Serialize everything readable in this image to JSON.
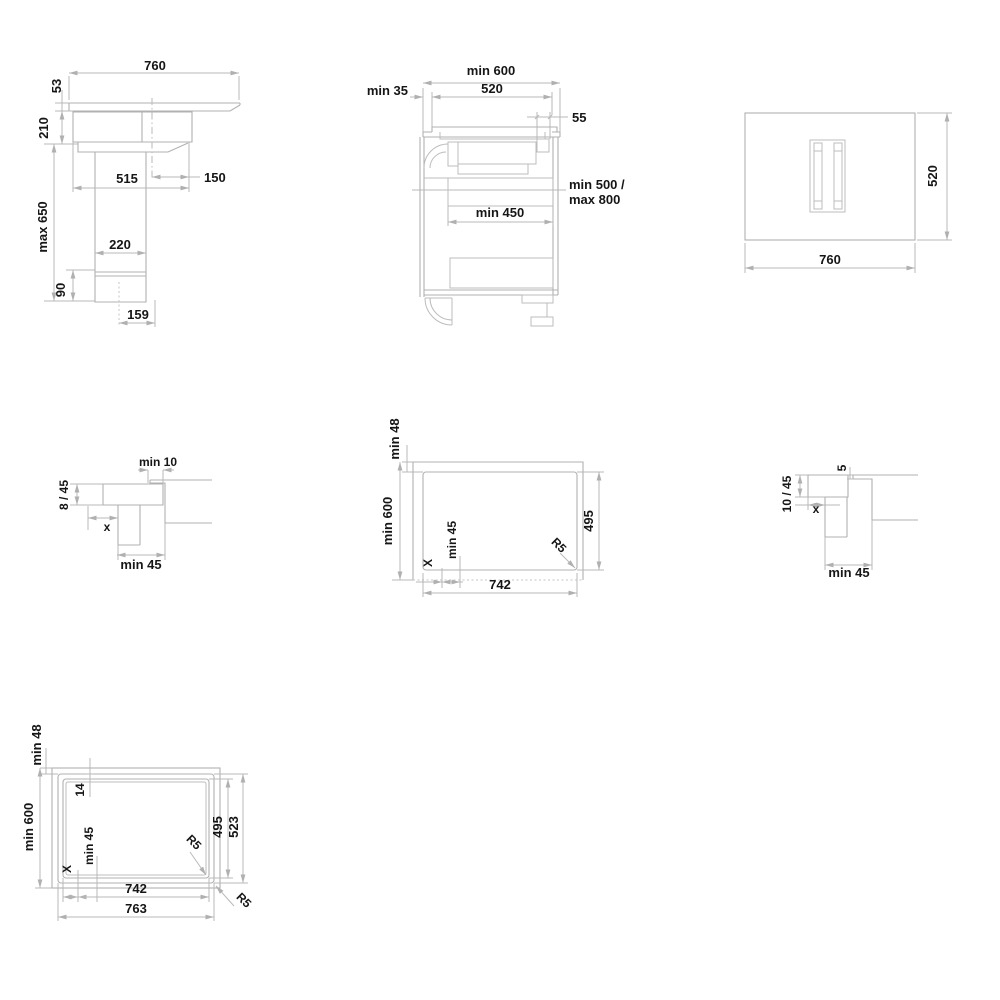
{
  "document": {
    "type": "appliance installation drawing",
    "subject": "downdraft induction hob – installation dimensions (mm)",
    "colors": {
      "line": "#b1b1b1",
      "dimension_line": "#b9b9b9",
      "text": "#161616",
      "background": "#ffffff"
    }
  },
  "v1": {
    "view": "side view hob with downdraft duct",
    "width": "760",
    "glass_h": "53",
    "housing_h": "210",
    "duct_max": "max 650",
    "body_w": "515",
    "offset": "150",
    "duct_w": "220",
    "outlet_h": "90",
    "outlet_w": "159"
  },
  "v2": {
    "view": "side view installed in base cabinet",
    "worktop_depth": "min 600",
    "hob_depth": "520",
    "front_clearance": "min 35",
    "rear_section": "55",
    "outlet_line1": "min 500 /",
    "outlet_line2": "max 800",
    "interior_depth": "min 450"
  },
  "v3": {
    "view": "top view hob",
    "width": "760",
    "depth": "520"
  },
  "v4": {
    "view": "edge detail surface mounted",
    "gap": "min 10",
    "height": "8 / 45",
    "x": "x",
    "clearance": "min 45"
  },
  "v5": {
    "view": "worktop cutout top view",
    "rear_clearance": "min 48",
    "worktop_depth": "min 600",
    "x": "X",
    "side_clearance": "min 45",
    "radius": "R5",
    "cutout_depth": "495",
    "cutout_width": "742"
  },
  "v6": {
    "view": "edge detail semi-flush mounted",
    "step": "5",
    "height": "10 / 45",
    "x": "x",
    "clearance": "min 45"
  },
  "v7": {
    "view": "flush mount cutout with rebate top view",
    "rear_clearance": "min 48",
    "worktop_depth": "min 600",
    "rebate": "14",
    "x": "X",
    "side_clearance": "min 45",
    "radius_inner": "R5",
    "radius_outer": "R5",
    "inner_width": "742",
    "outer_width": "763",
    "inner_depth": "495",
    "outer_depth": "523"
  }
}
